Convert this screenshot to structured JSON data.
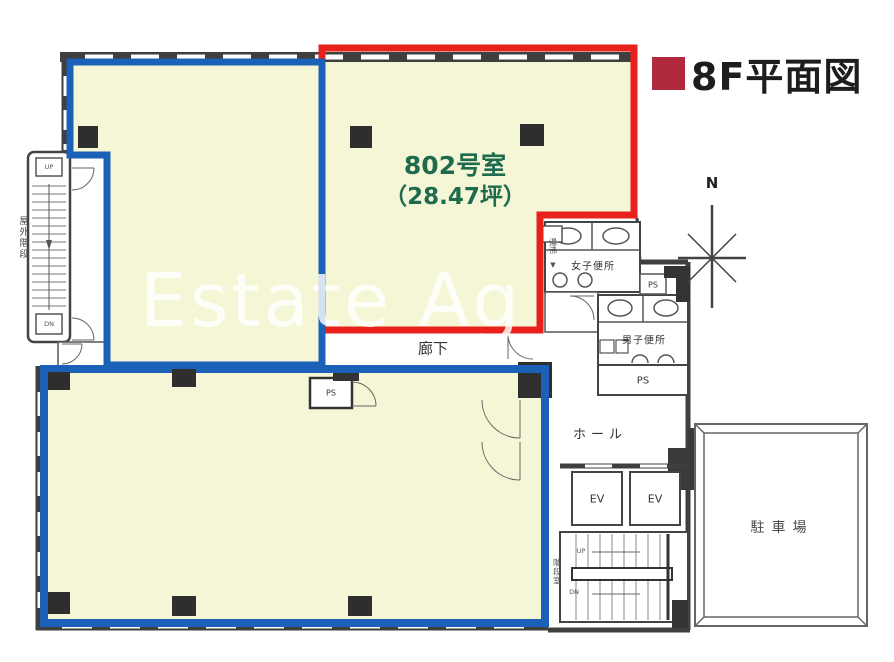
{
  "header": {
    "title": "8F平面図"
  },
  "watermark": {
    "text": "Estate Ag"
  },
  "unit802": {
    "name": "802号室",
    "area": "（28.47坪）"
  },
  "rooms": {
    "corridor": "廊下",
    "hall": "ホール",
    "womens_toilet": "女子便所",
    "mens_toilet": "男子便所",
    "parking": "駐車場",
    "outdoor_stairs": "屋外階段",
    "stairwell": "階段室",
    "kitchenette": "湯沸"
  },
  "labels": {
    "elevator": "EV",
    "pipe_shaft": "PS",
    "up": "UP",
    "down": "DN",
    "north": "N",
    "down_arrow": "▼"
  },
  "colors": {
    "unit_outline_red": "#e8211d",
    "other_unit_outline_blue": "#1b61b7",
    "room_fill_yellow": "#f5f6d6",
    "title_accent_red": "#b0293c",
    "unit_text_green": "#1f6b4d",
    "wall_gray": "#3f3f3f"
  }
}
